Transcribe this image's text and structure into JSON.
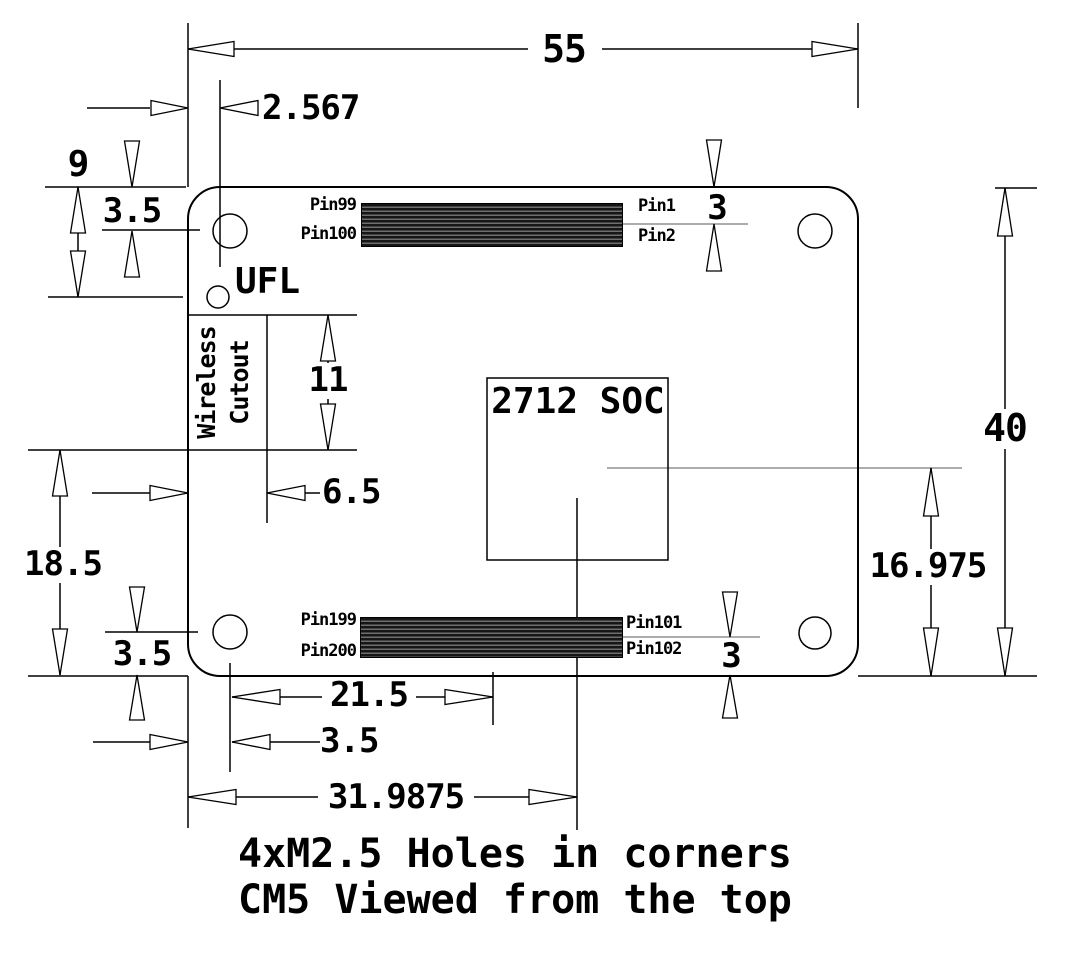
{
  "figure": {
    "caption_line1": "4xM2.5 Holes in corners",
    "caption_line2": "CM5 Viewed from the top"
  },
  "board": {
    "soc_label": "2712 SOC",
    "ufl_label": "UFL",
    "wireless_cutout": [
      "Wireless",
      "Cutout"
    ]
  },
  "pins": {
    "p99": "Pin99",
    "p100": "Pin100",
    "p1": "Pin1",
    "p2": "Pin2",
    "p199": "Pin199",
    "p200": "Pin200",
    "p101": "Pin101",
    "p102": "Pin102"
  },
  "dimensions": {
    "board_width": "55",
    "board_height": "40",
    "ufl_offset_x": "2.567",
    "ufl_offset_y": "9",
    "top_hole_offset_y": "3.5",
    "top_pin_row_offset": "3",
    "cutout_height": "11",
    "cutout_width": "6.5",
    "cutout_to_bottom": "18.5",
    "bottom_hole_offset_y": "3.5",
    "hole_to_connector_center": "21.5",
    "hole_offset_x": "3.5",
    "soc_center_from_left": "31.9875",
    "soc_center_from_bottom": "16.975",
    "bottom_pin_row_offset": "3"
  },
  "colors": {
    "line": "#000000",
    "centerline": "#7a7a7a",
    "connector_dark": "#161616",
    "connector_light": "#6e6e6e",
    "background": "#ffffff"
  }
}
